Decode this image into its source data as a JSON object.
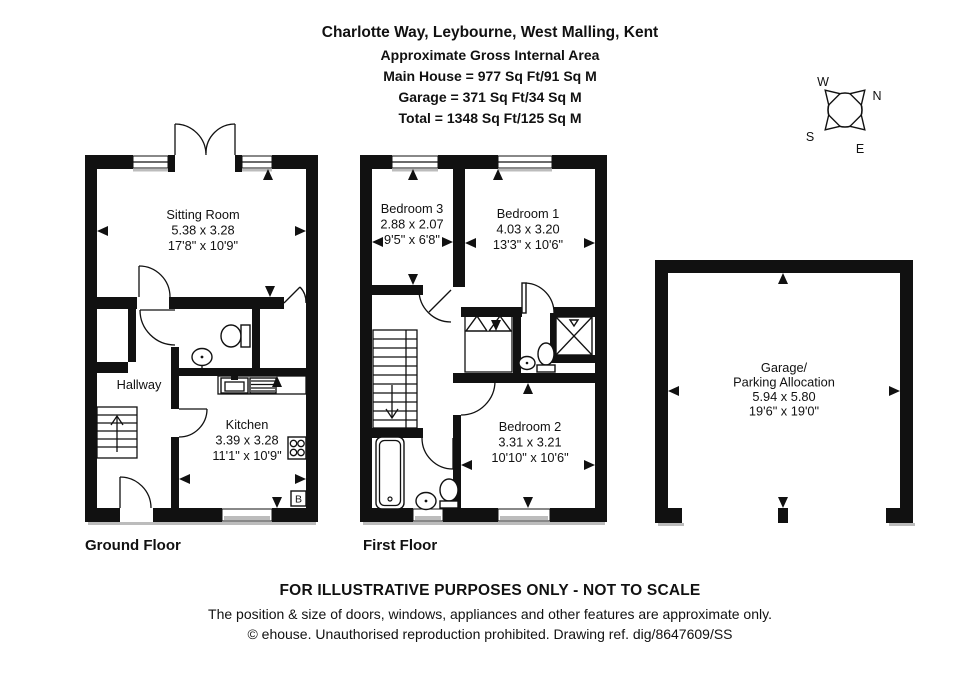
{
  "header": {
    "title": "Charlotte Way, Leybourne, West Malling, Kent",
    "subtitle": "Approximate Gross Internal Area",
    "area_main": "Main House = 977 Sq Ft/91 Sq M",
    "area_garage": "Garage = 371 Sq Ft/34 Sq M",
    "area_total": "Total = 1348 Sq Ft/125 Sq M"
  },
  "compass": {
    "n": "N",
    "s": "S",
    "e": "E",
    "w": "W"
  },
  "floors": {
    "ground": {
      "label": "Ground Floor",
      "sitting": {
        "name": "Sitting Room",
        "metric": "5.38 x 3.28",
        "imperial": "17'8\" x 10'9\""
      },
      "hallway": {
        "name": "Hallway"
      },
      "kitchen": {
        "name": "Kitchen",
        "metric": "3.39 x 3.28",
        "imperial": "11'1\" x 10'9\""
      },
      "boiler": "B"
    },
    "first": {
      "label": "First Floor",
      "bedroom3": {
        "name": "Bedroom 3",
        "metric": "2.88 x 2.07",
        "imperial": "9'5\" x 6'8\""
      },
      "bedroom1": {
        "name": "Bedroom 1",
        "metric": "4.03 x 3.20",
        "imperial": "13'3\" x 10'6\""
      },
      "bedroom2": {
        "name": "Bedroom 2",
        "metric": "3.31 x 3.21",
        "imperial": "10'10\" x 10'6\""
      }
    },
    "garage": {
      "name_line1": "Garage/",
      "name_line2": "Parking Allocation",
      "metric": "5.94 x 5.80",
      "imperial": "19'6\" x 19'0\""
    }
  },
  "footer": {
    "line1": "FOR ILLUSTRATIVE PURPOSES ONLY - NOT TO SCALE",
    "line2": "The position & size of doors, windows, appliances and other features are approximate only.",
    "line3": "© ehouse. Unauthorised reproduction prohibited. Drawing ref. dig/8647609/SS"
  },
  "colors": {
    "ink": "#111111",
    "shadow": "#bcbcbc",
    "background": "#ffffff"
  }
}
